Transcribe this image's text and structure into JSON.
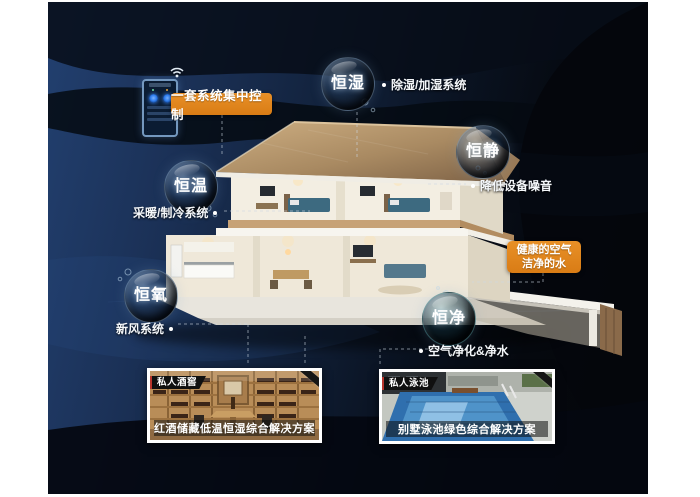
{
  "bubbles": [
    {
      "label": "恒湿",
      "note": "除湿/加湿系统"
    },
    {
      "label": "恒静",
      "note": "降低设备噪音"
    },
    {
      "label": "恒温",
      "note": "采暖/制冷系统"
    },
    {
      "label": "恒氧",
      "note": "新风系统"
    },
    {
      "label": "恒净",
      "note": "空气净化&净水"
    }
  ],
  "callouts": {
    "central_control": "一套系统集中控制",
    "healthy_air_line1": "健康的空气",
    "healthy_air_line2": "洁净的水"
  },
  "cards": [
    {
      "badge": "私人酒窖",
      "caption": "红酒储藏低温恒湿综合解决方案"
    },
    {
      "badge": "私人泳池",
      "caption": "别墅泳池绿色综合解决方案"
    }
  ],
  "icons": {
    "wifi": "wifi-icon",
    "phone": "smart-controller-phone"
  },
  "colors": {
    "accent_orange": "#db8118",
    "background_navy": "#1b3157",
    "background_black": "#04060a",
    "bubble_text": "#ffffff",
    "badge_red": "#b8352c"
  }
}
